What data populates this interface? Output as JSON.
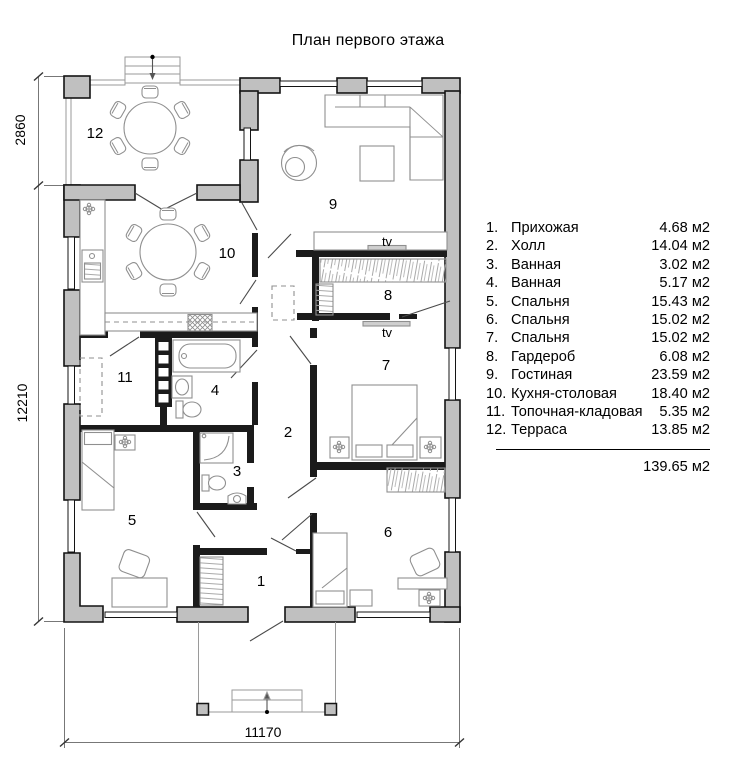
{
  "title": "План первого этажа",
  "rooms": {
    "n1": "1",
    "n2": "2",
    "n3": "3",
    "n4": "4",
    "n5": "5",
    "n6": "6",
    "n7": "7",
    "n8": "8",
    "n9": "9",
    "n10": "10",
    "n11": "11",
    "n12": "12"
  },
  "tv": {
    "top": "tv",
    "bottom": "tv"
  },
  "dimensions": {
    "terrace_height": "2860",
    "house_height": "12210",
    "house_width": "11170"
  },
  "legend": {
    "items": [
      {
        "num": "1.",
        "name": "Прихожая",
        "area": "4.68 м2"
      },
      {
        "num": "2.",
        "name": "Холл",
        "area": "14.04 м2"
      },
      {
        "num": "3.",
        "name": "Ванная",
        "area": "3.02 м2"
      },
      {
        "num": "4.",
        "name": "Ванная",
        "area": "5.17 м2"
      },
      {
        "num": "5.",
        "name": "Спальня",
        "area": "15.43 м2"
      },
      {
        "num": "6.",
        "name": "Спальня",
        "area": "15.02 м2"
      },
      {
        "num": "7.",
        "name": "Спальня",
        "area": "15.02 м2"
      },
      {
        "num": "8.",
        "name": "Гардероб",
        "area": "6.08 м2"
      },
      {
        "num": "9.",
        "name": "Гостиная",
        "area": "23.59 м2"
      },
      {
        "num": "10.",
        "name": "Кухня-столовая",
        "area": "18.40 м2"
      },
      {
        "num": "11.",
        "name": "Топочная-кладовая",
        "area": "5.35 м2"
      },
      {
        "num": "12.",
        "name": "Терраса",
        "area": "13.85 м2"
      }
    ],
    "total": "139.65 м2"
  }
}
